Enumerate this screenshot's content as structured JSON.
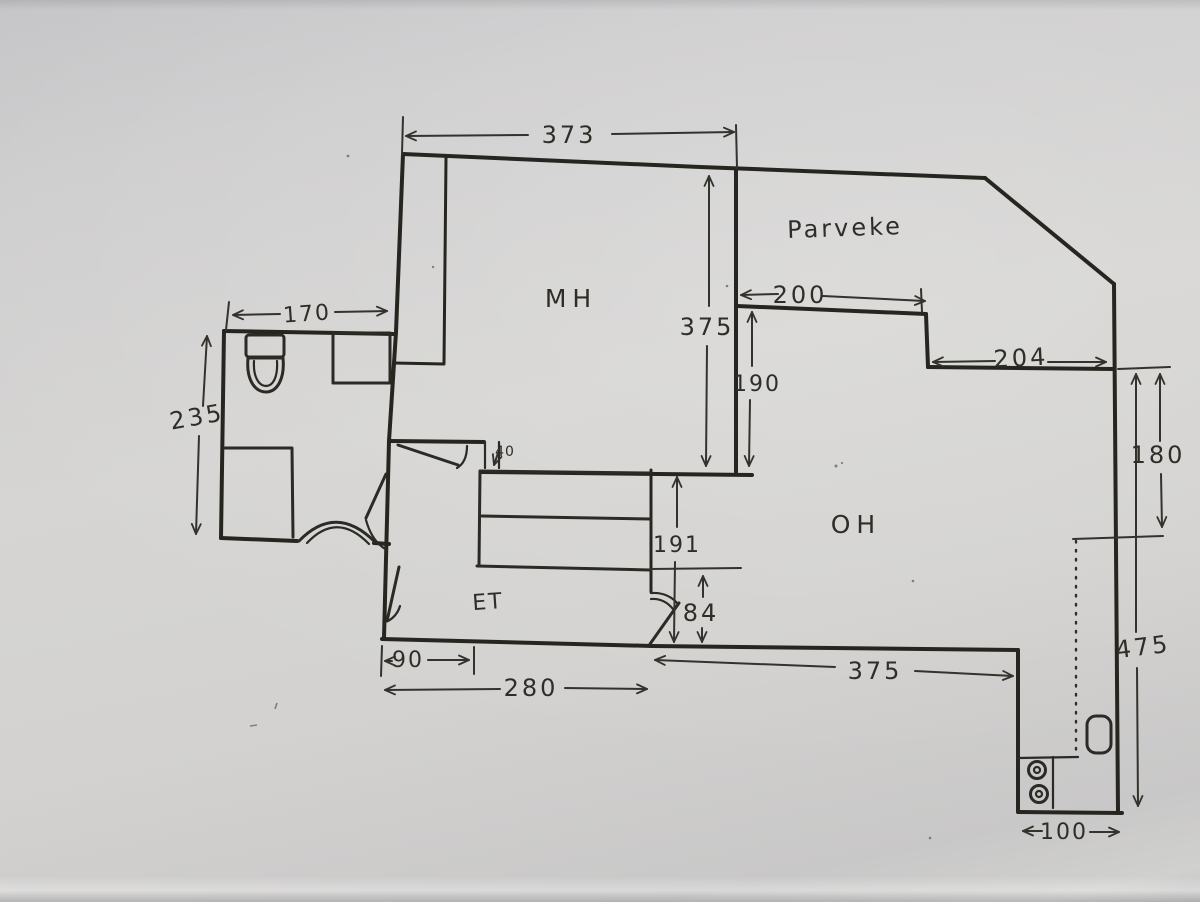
{
  "document": {
    "type": "hand-drawn apartment floor plan sketch on gray paper",
    "unit": "cm"
  },
  "colors": {
    "paper": "#d3d2d0",
    "ink": "#2b2a26"
  },
  "rooms": {
    "mh": "MH",
    "parveke": "Parveke",
    "oh": "OH",
    "et": "ET"
  },
  "dimensions": {
    "top_width": "373",
    "mh_height": "375",
    "balcony_recess_width": "200",
    "balcony_step_depth": "190",
    "balcony_right_width": "204",
    "right_upper_height": "180",
    "right_total_height": "475",
    "bath_width": "170",
    "bath_height": "235",
    "wall_stub": "40",
    "closet_height": "191",
    "door_offset": "84",
    "entry_left_width": "90",
    "entry_width": "280",
    "oh_bottom_width": "375",
    "bottom_right_width": "100"
  }
}
